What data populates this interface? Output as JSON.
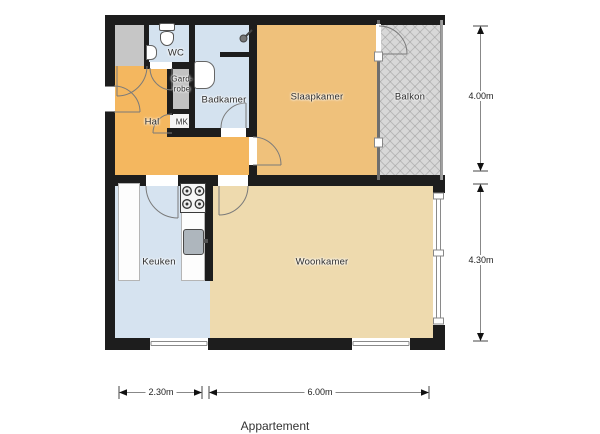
{
  "title": {
    "label": "Appartement"
  },
  "rooms": {
    "hal": {
      "label": "Hal"
    },
    "wc": {
      "label": "WC"
    },
    "garderobe": {
      "label_line1": "Gard-",
      "label_line2": "robe"
    },
    "badkamer": {
      "label": "Badkamer"
    },
    "mk": {
      "label": "MK"
    },
    "slaapkamer": {
      "label": "Slaapkamer"
    },
    "balkon": {
      "label": "Balkon"
    },
    "keuken": {
      "label": "Keuken"
    },
    "woonkamer": {
      "label": "Woonkamer"
    }
  },
  "dimensions": {
    "right_top": "4.00m",
    "right_bottom": "4.30m",
    "bottom_left": "2.30m",
    "bottom_right": "6.00m"
  },
  "colors": {
    "wall": "#1d1d1d",
    "hal": "#f4b75f",
    "slaapkamer": "#efc17b",
    "woonkamer": "#eedaae",
    "badkamer_wc_blue": "#d4e2ef",
    "keuken": "#d6e3f0",
    "balkon_gray": "#d8d8d8",
    "closet_gray": "#c6c6c6",
    "garderobe_gray": "#c2c2c2",
    "mk_white": "#f4f4f4",
    "background": "#ffffff"
  },
  "icons": {
    "toilet": "css-shape",
    "wc_sink": "css-shape",
    "bathroom_sink": "css-shape",
    "shower_head": "svg-shape",
    "stove_burners": "svg-circles",
    "kitchen_sink": "css-shape",
    "door_arcs": "svg-arcs",
    "dimension_arrows": "svg-triangles"
  }
}
